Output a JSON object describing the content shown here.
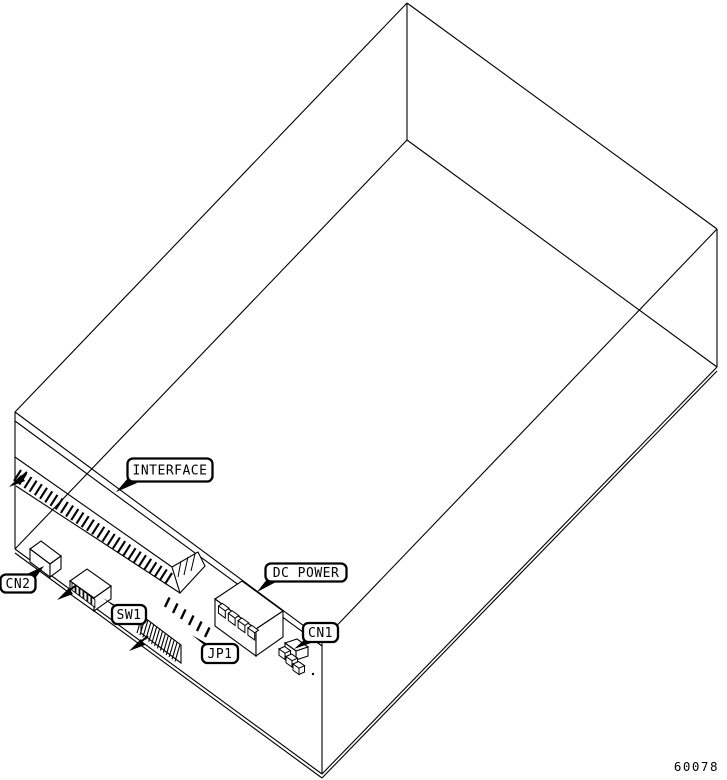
{
  "figure": {
    "type": "isometric-line-drawing",
    "description": "Disk drive chassis shown in wireframe with rear PCB connectors and callout labels",
    "drawing_number": "60078",
    "colors": {
      "line": "#000000",
      "background": "#ffffff"
    }
  },
  "callouts": {
    "interface": {
      "label": "INTERFACE"
    },
    "cn2": {
      "label": "CN2"
    },
    "sw1": {
      "label": "SW1"
    },
    "jp1": {
      "label": "JP1"
    },
    "dc_power": {
      "label": "DC POWER"
    },
    "cn1": {
      "label": "CN1"
    }
  },
  "components": {
    "interface_connector": {
      "contact_teeth": 30
    },
    "cn2_connector": {
      "type": "small-box-connector"
    },
    "sw1_dip_switch": {
      "positions": 6
    },
    "jp1_jumper_block": {
      "pins": 6,
      "hatch_lines": 14
    },
    "dc_power_connector": {
      "pins": 4
    },
    "cn1_connector": {
      "steps": 3
    }
  }
}
